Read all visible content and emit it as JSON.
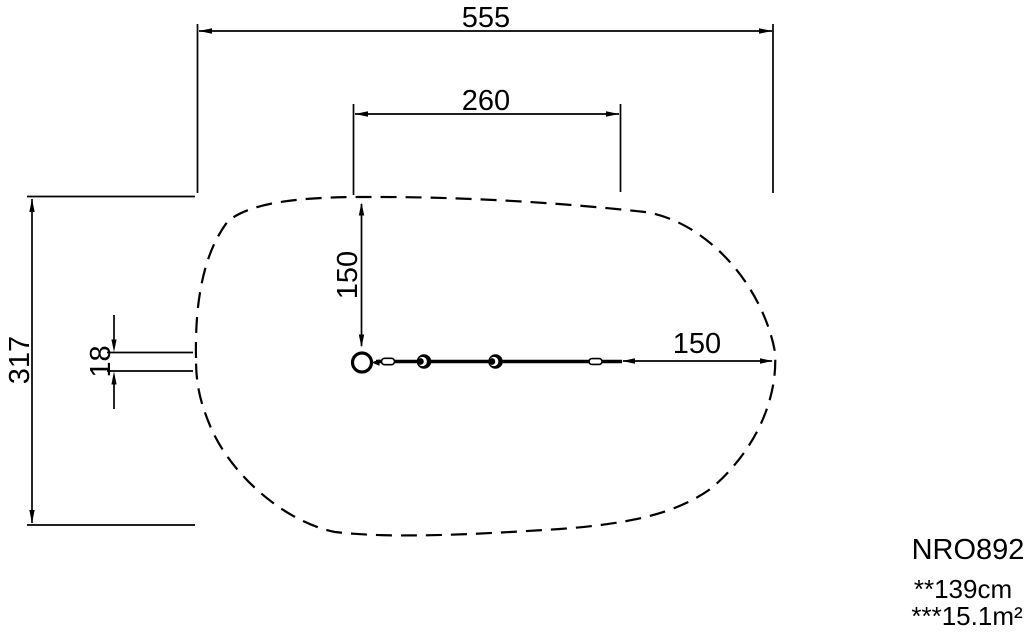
{
  "drawing": {
    "dimensions": {
      "total_width": "555",
      "platform_width": "260",
      "total_height": "317",
      "anchor_width": "18",
      "clearance_top": "150",
      "clearance_right": "150"
    },
    "legend": {
      "product_code": "NRO892",
      "fall_height_note": "**139cm",
      "safety_area_note": "***15.1m²"
    },
    "colors": {
      "line": "#000000",
      "background": "#ffffff"
    }
  }
}
